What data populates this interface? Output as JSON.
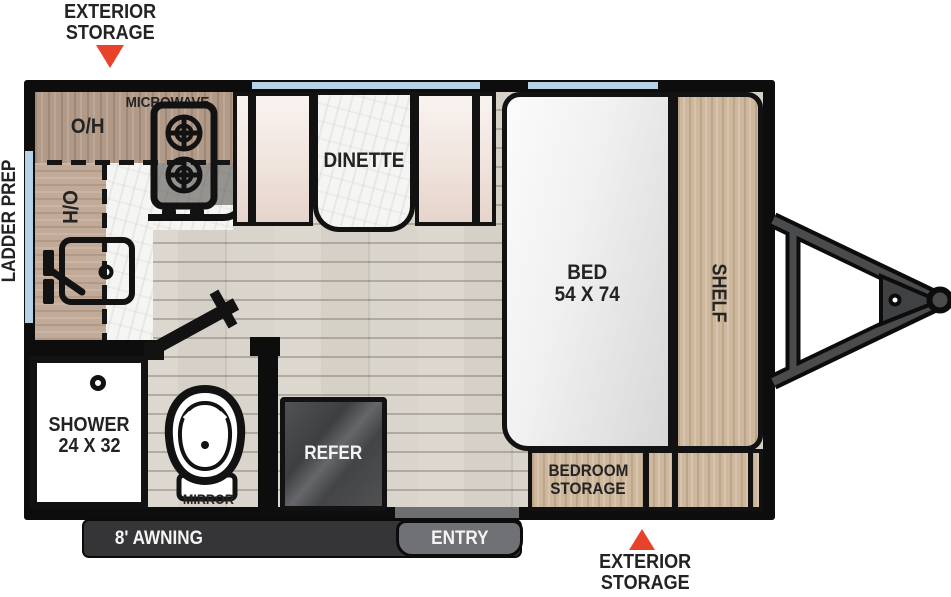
{
  "callouts": {
    "front_storage_line1": "EXTERIOR",
    "front_storage_line2": "STORAGE",
    "rear_storage_line1": "EXTERIOR",
    "rear_storage_line2": "STORAGE",
    "ladder_prep": "LADDER PREP"
  },
  "kitchen": {
    "microwave": "MICROWAVE",
    "overhead_top": "O/H",
    "overhead_side": "O/H"
  },
  "dinette": {
    "label": "DINETTE"
  },
  "bedroom": {
    "bed": "BED",
    "bed_size": "54 X 74",
    "shelf": "SHELF",
    "storage_line1": "BEDROOM",
    "storage_line2": "STORAGE"
  },
  "bathroom": {
    "shower": "SHOWER",
    "shower_size": "24 X 32",
    "mirror": "MIRROR"
  },
  "appliances": {
    "refrigerator": "REFER"
  },
  "exterior_features": {
    "awning": "8' AWNING",
    "entry": "ENTRY"
  },
  "colors": {
    "marker_red": "#e8432a",
    "wall_black": "#0d0d0e",
    "window_blue": "#b7d1e6",
    "awning_bar": "#353537",
    "entry_badge": "#707174",
    "refer_gray": "#4a4b4d",
    "cabinet_wood": "#b29a89",
    "light_wood": "#cdb79d",
    "floor": "#ddd8cf"
  }
}
